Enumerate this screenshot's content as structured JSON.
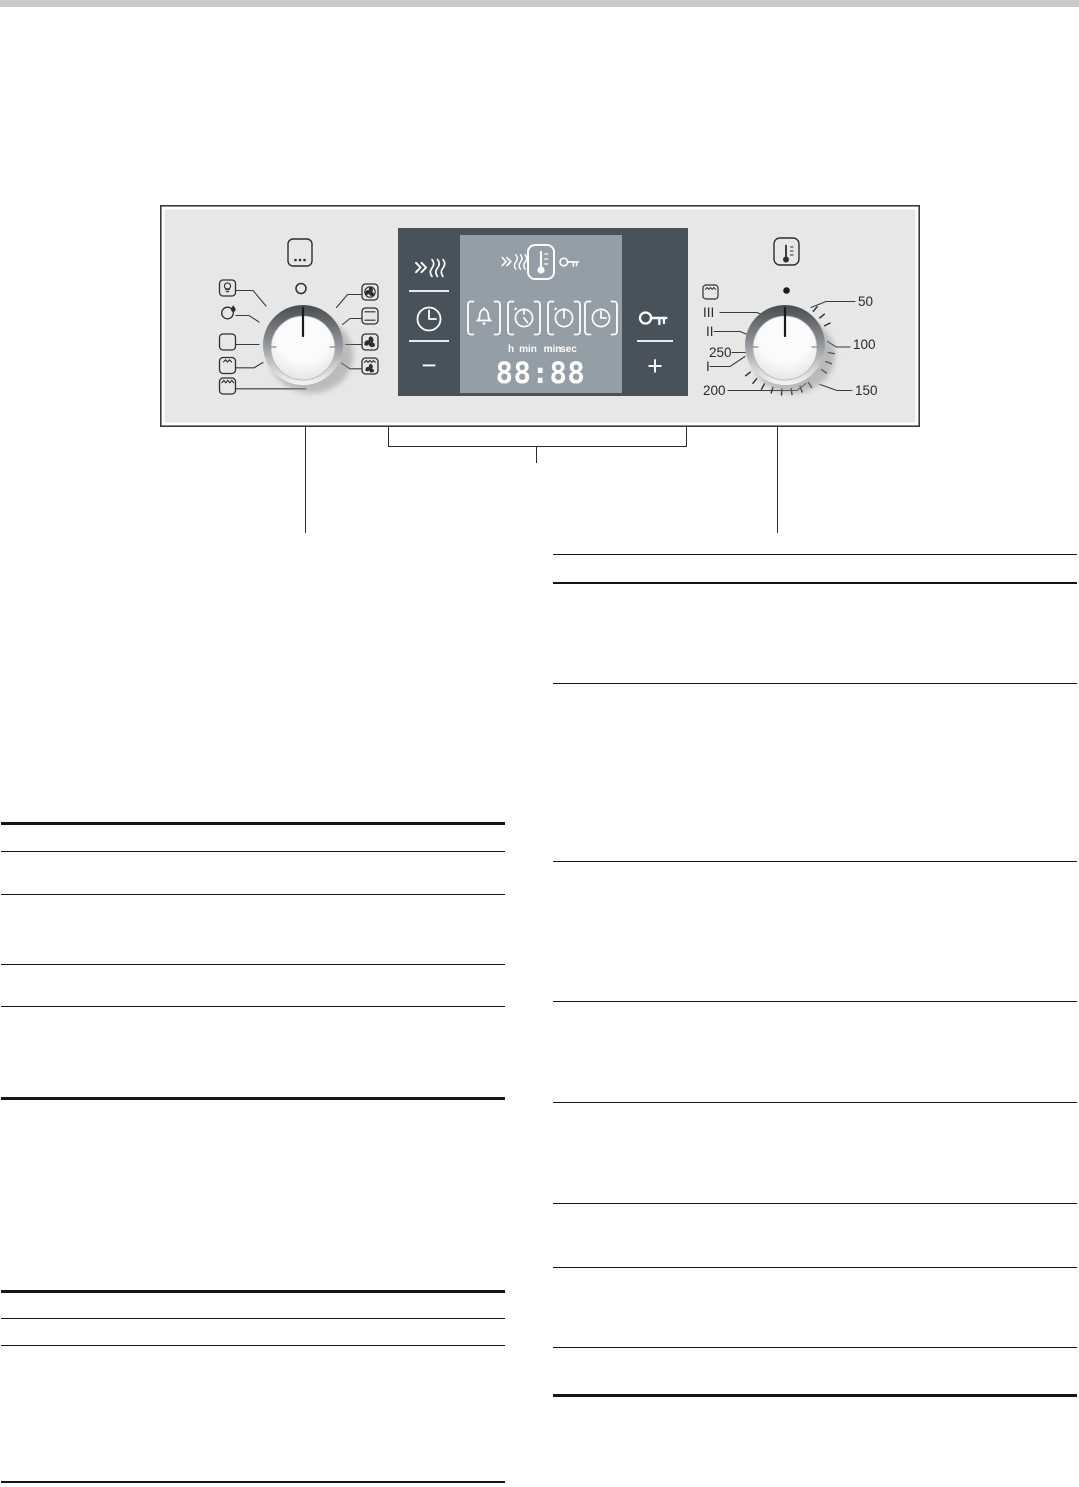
{
  "colors": {
    "top_band": "#c9c9c9",
    "panel_bg": "#e7e7e7",
    "panel_border": "#3b3b3b",
    "display_bg": "#47525a",
    "display_inner": "#949ea6",
    "icon_white": "#ffffff",
    "label_dark": "#2b2b2b"
  },
  "control_panel": {
    "function_selector": {
      "more_button_icon": "ellipsis",
      "indicator_icon": "position-marker-circle",
      "icons_left": [
        "oven-light",
        "defrost",
        "off",
        "grill-small-area",
        "grill-large-area"
      ],
      "icons_right": [
        "hot-air",
        "top-bottom-heating",
        "hot-air-gentle",
        "grill-fan"
      ]
    },
    "display": {
      "time": "88:88",
      "unit_labels": [
        "h",
        "min",
        "min",
        "sec"
      ],
      "minus_label": "−",
      "plus_label": "+",
      "icons": [
        "rapid-heat",
        "clock",
        "rapid-heat",
        "thermometer",
        "key",
        "alarm-bell",
        "timer-duration",
        "timer-end",
        "clock-time",
        "key"
      ]
    },
    "temperature_selector": {
      "button_icon": "thermometer",
      "corner_icon": "grill",
      "indicator_icon": "dot",
      "scale_left": [
        "III",
        "II",
        "250",
        "I",
        "200"
      ],
      "scale_right": [
        "50",
        "100",
        "150"
      ]
    }
  }
}
